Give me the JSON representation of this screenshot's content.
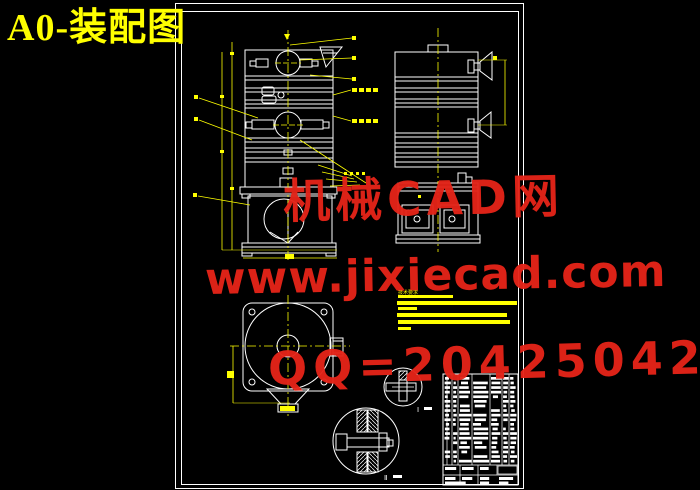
{
  "window": {
    "title": "A0-装配图"
  },
  "watermark": {
    "line1": "机械CAD网",
    "line2": "www.jixiecad.com",
    "line3": "QQ=20425042",
    "color": "#e42418"
  },
  "drawing": {
    "tech_notes_title": "技术要求",
    "detail_labels": {
      "detail1": "Ⅰ",
      "detail2": "Ⅱ"
    },
    "colors": {
      "background": "#000000",
      "lines": "#ffffff",
      "annotations": "#ffff00",
      "watermark": "#e42418",
      "title": "#ffff00"
    }
  }
}
